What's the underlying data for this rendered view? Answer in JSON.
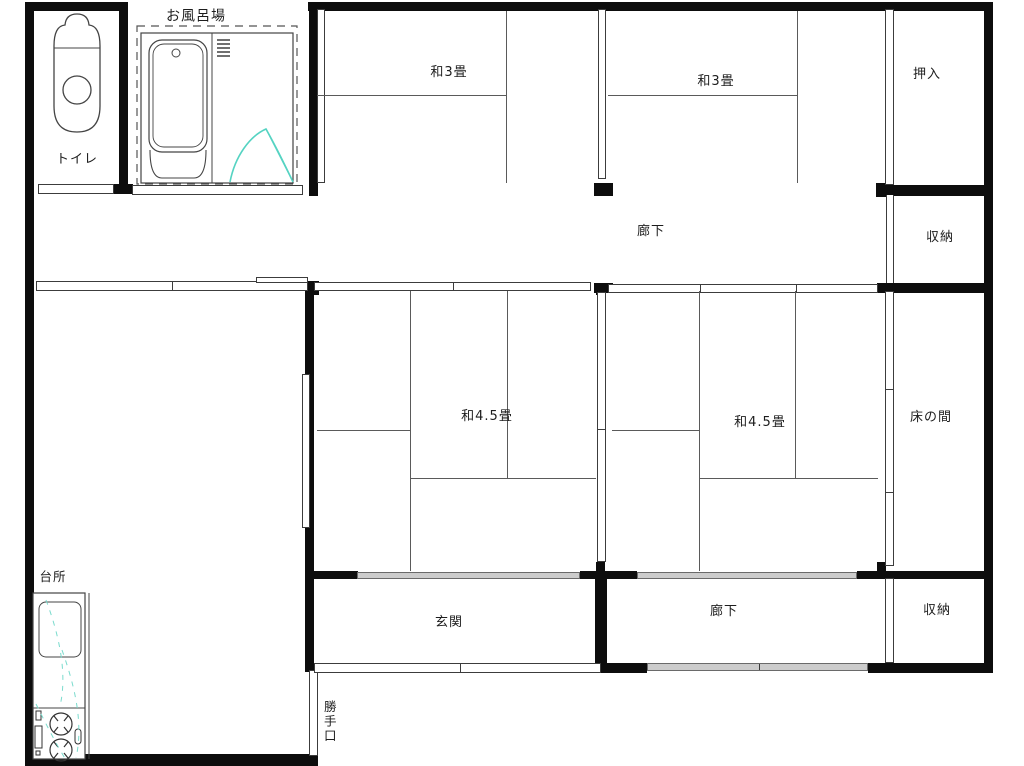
{
  "plan": {
    "type": "japanese-house-floor-plan",
    "labels": {
      "bath": "お風呂場",
      "toilet": "トイレ",
      "washitsu3_a": "和3畳",
      "washitsu3_b": "和3畳",
      "oshiire": "押入",
      "hallway_top": "廊下",
      "storage_top": "収納",
      "washitsu45_a": "和4.5畳",
      "washitsu45_b": "和4.5畳",
      "tokonoma": "床の間",
      "genkan": "玄関",
      "hallway_bottom": "廊下",
      "storage_bottom": "収納",
      "kitchen": "台所",
      "backdoor": "勝手口"
    },
    "colors": {
      "wall": "#0d0d0d",
      "tatami_line": "#5a5a5a",
      "accent_teal": "#55d3c2",
      "sliding_panel_gray": "#cccccc",
      "background": "#ffffff"
    },
    "fixtures": [
      "toilet",
      "bathtub",
      "shower-drain-grate",
      "kitchen-sink",
      "two-burner-stove"
    ]
  }
}
